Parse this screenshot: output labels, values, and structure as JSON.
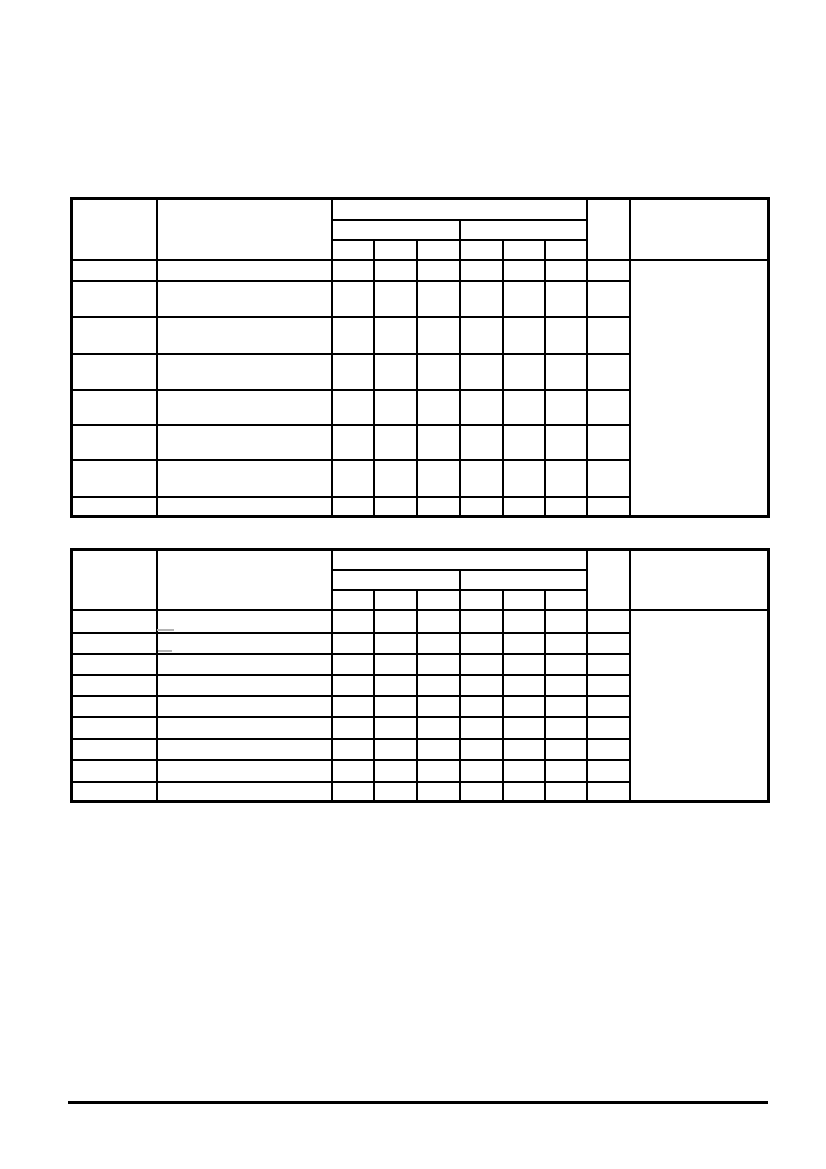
{
  "page": {
    "kind": "scanned-document-page",
    "background_color": "#ffffff",
    "line_color": "#000000",
    "visible_text": ""
  },
  "upper_table": {
    "all_cells_empty": true,
    "header_row_count": 3,
    "body_row_count": 8,
    "column_count": 10,
    "group_span_columns": 6,
    "subgroup_spans": [
      3,
      3
    ],
    "right_column_body_merged": true
  },
  "lower_table": {
    "all_cells_empty": true,
    "header_row_count": 3,
    "body_row_count": 9,
    "column_count": 10,
    "group_span_columns": 6,
    "subgroup_spans": [
      3,
      3
    ],
    "right_column_body_merged": true
  },
  "artifacts": {
    "faint_dash_count": 2,
    "color": "#b4b4b4"
  },
  "footer": {
    "horizontal_rule": true,
    "rule_color": "#000000"
  }
}
